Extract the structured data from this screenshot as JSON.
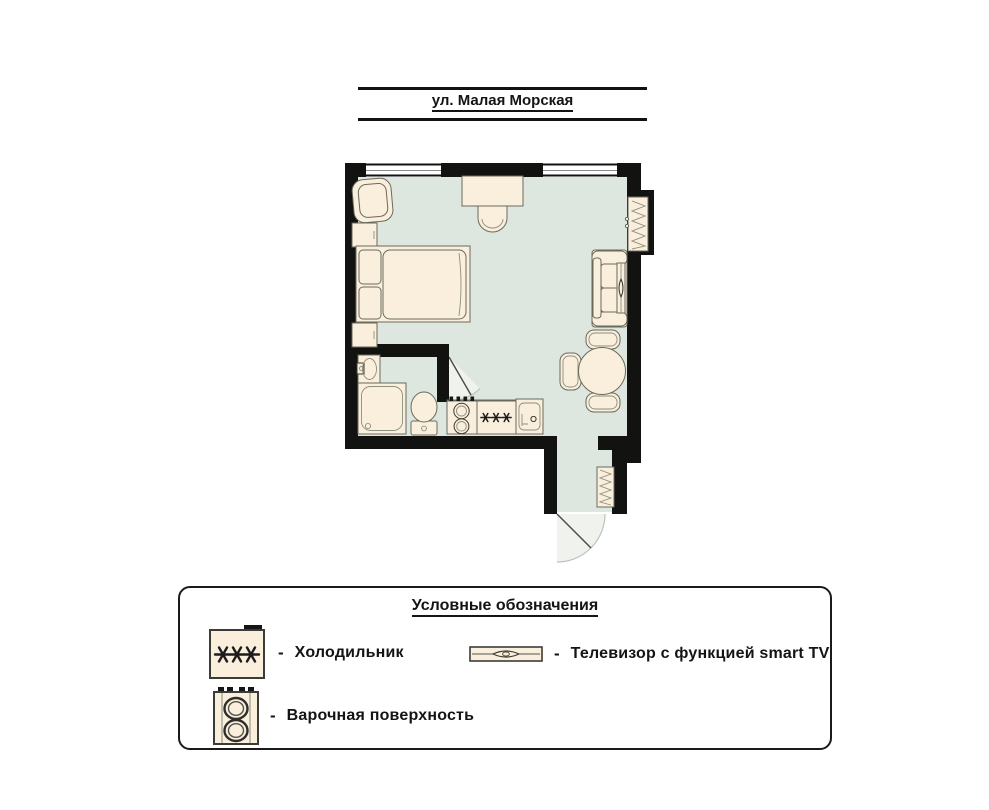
{
  "street_banner": {
    "name": "ул. Малая Морская"
  },
  "legend": {
    "title": "Условные обозначения",
    "items": [
      {
        "icon": "fridge-icon",
        "dash": "-",
        "label": "Холодильник"
      },
      {
        "icon": "tv-icon",
        "dash": "-",
        "label": "Телевизор с функцией smart TV"
      },
      {
        "icon": "hob-icon",
        "dash": "-",
        "label": "Варочная поверхность"
      }
    ]
  },
  "icons": {
    "freezer_stars_symbol": "✳✳✳",
    "fridge": "rectangle with three six-spoke asterisks",
    "tv": "thin bar with lens oval",
    "hob": "panel with two burner rings and four knobs",
    "radiator": "zigzag coil strip"
  },
  "colors": {
    "wall": "#121210",
    "floor": "#dde7df",
    "furniture_fill": "#faeedc",
    "furniture_stroke": "#6a6a5c",
    "text": "#141414",
    "background": "#ffffff"
  }
}
